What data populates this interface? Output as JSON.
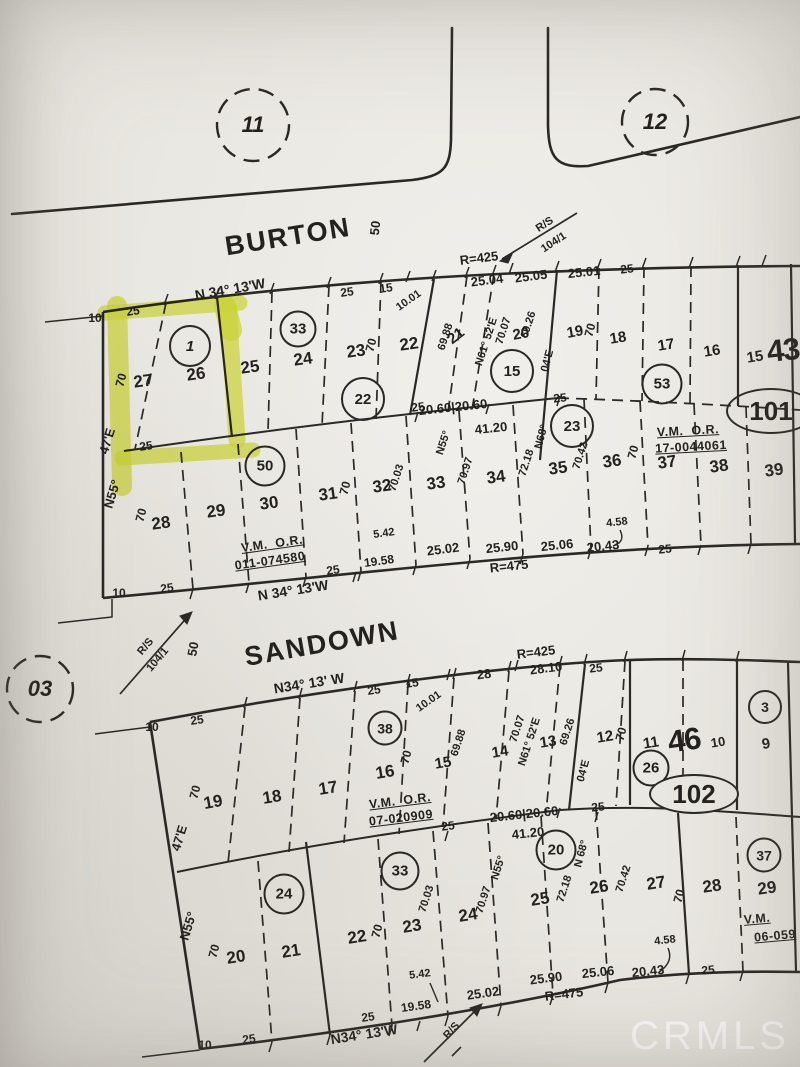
{
  "watermark": "CRMLS",
  "jct": {
    "c11": "11",
    "c12": "12"
  },
  "burton": {
    "name": "BURTON",
    "width": "50",
    "rs": "R/S",
    "rs_ref": "104/1",
    "radius": "R=425",
    "bearing": "N 34° 13'W",
    "t25": "25",
    "t15": "15",
    "t1001": "10.01",
    "t2504": "25.04",
    "t2505": "25.05",
    "t2501": "25.01",
    "t25b": "25"
  },
  "a1": {
    "n10": "10",
    "d25": "25",
    "lots": [
      "27",
      "26",
      "25",
      "24",
      "23",
      "22",
      "21",
      "20",
      "19",
      "18",
      "17",
      "16",
      "15"
    ],
    "big": "43",
    "c1": "1",
    "c33": "33",
    "c22": "22",
    "c15": "15",
    "c53": "53",
    "oval": "101",
    "d70_27": "70",
    "d70_23": "70",
    "d6988": "69.88",
    "n61": "N61° 52'E",
    "d7007": "70.07",
    "d6926": "69.26",
    "d70_19": "70",
    "d04e": "04'E",
    "n68": "N68°",
    "n55b": "N55°",
    "vm": "V.M.  O.R.",
    "vm_ref": "17-0044061",
    "n55": "N55°",
    "e47": "47'E",
    "d25bl": "25"
  },
  "amid": {
    "d25a": "25",
    "d2060": "20.60|20.60",
    "d4120": "41.20",
    "d25b": "25",
    "c23": "23"
  },
  "a2": {
    "lots": [
      "28",
      "29",
      "30",
      "31",
      "32",
      "33",
      "34",
      "35",
      "36",
      "37",
      "38",
      "39"
    ],
    "c50": "50",
    "d70_28": "70",
    "d70_31": "70",
    "d7003": "70.03",
    "d7097": "70.97",
    "d7218": "72.18",
    "d7042": "70.42",
    "d70_36": "70",
    "d458": "4.58",
    "vm": "V.M.  O.R.",
    "vm_ref": "011-074580",
    "b25": "25",
    "b1958": "19.58",
    "b542": "5.42",
    "b2502": "25.02",
    "b2590": "25.90",
    "b2506": "25.06",
    "b2043": "20.43",
    "b25r": "25",
    "radius": "R=475",
    "n10": "10",
    "d25": "25",
    "bearing": "N 34° 13'W"
  },
  "between": {
    "rs": "R/S",
    "rs_ref": "104/1",
    "width": "50"
  },
  "sandown": {
    "name": "SANDOWN",
    "c03": "03",
    "bearing": "N34° 13' W",
    "radius": "R=425",
    "t25": "25",
    "t15": "15",
    "t1001": "10.01",
    "t28": "28",
    "t2810": "28.10",
    "t25b": "25"
  },
  "b1": {
    "n10": "10",
    "d25": "25",
    "lots": [
      "19",
      "18",
      "17",
      "16",
      "15",
      "14",
      "13",
      "12",
      "11",
      "10",
      "9"
    ],
    "big": "46",
    "c38": "38",
    "c26": "26",
    "c3": "3",
    "oval": "102",
    "d70_19": "70",
    "d70_16": "70",
    "d6988": "69.88",
    "d7007": "70.07",
    "n61": "N61° 52'E",
    "d6926": "69.26",
    "d04e": "04'E",
    "d70_12": "70",
    "vm": "V.M.  O.R.",
    "vm_ref": "07-020909",
    "n55": "N55°",
    "e47": "47'E"
  },
  "bmid": {
    "d25a": "25",
    "d2060": "20.60|20.60",
    "d25b": "25",
    "d4120": "41.20",
    "c20": "20",
    "n68": "N 68°"
  },
  "b2": {
    "lots": [
      "20",
      "21",
      "22",
      "23",
      "24",
      "25",
      "26",
      "27",
      "28",
      "29"
    ],
    "c24": "24",
    "c33": "33",
    "c37": "37",
    "d70_20": "70",
    "d70_22": "70",
    "d70_27": "70",
    "d7003": "70.03",
    "d7097": "70.97",
    "d7218": "72.18",
    "d7042": "70.42",
    "n55b": "N55°",
    "d458": "4.58",
    "vm": "V.M.",
    "vm_ref": "06-059",
    "b542": "5.42",
    "b1958": "19.58",
    "b25": "25",
    "b2502": "25.02",
    "b2590": "25.90",
    "b2506": "25.06",
    "b2043": "20.43",
    "b25r": "25",
    "radius": "R=475",
    "n10": "10",
    "d25": "25",
    "bearing": "N34° 13'W",
    "rs": "R/S"
  }
}
